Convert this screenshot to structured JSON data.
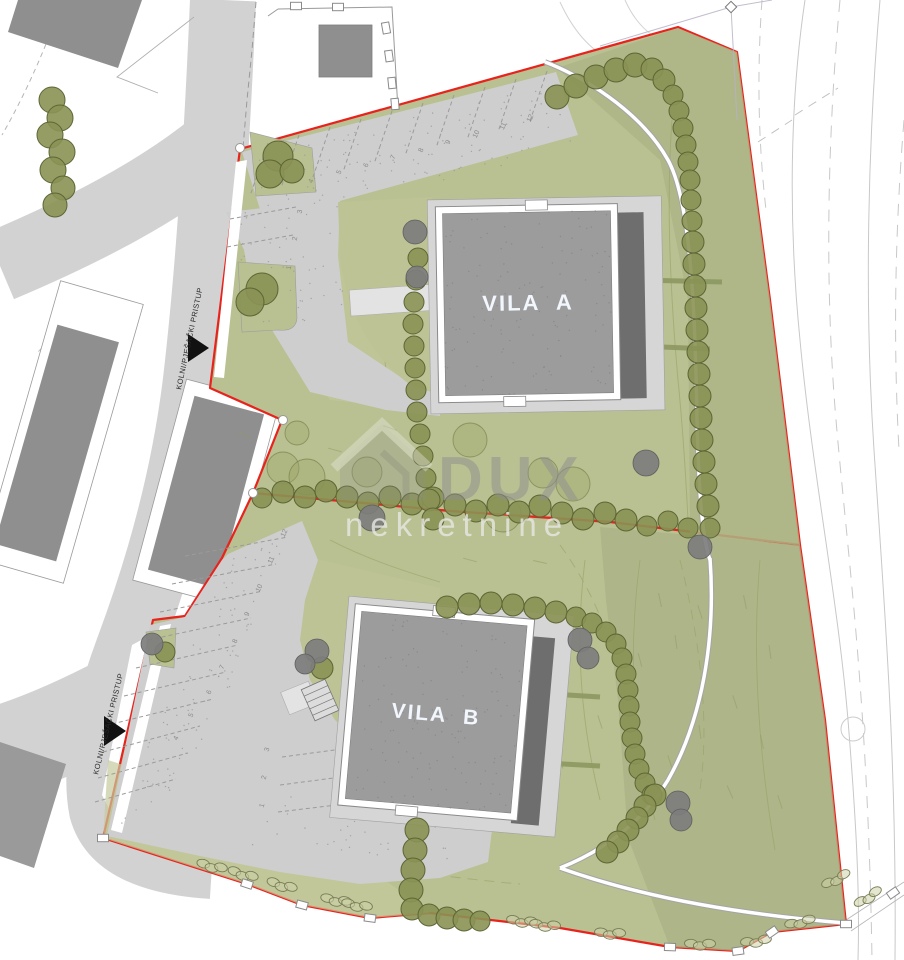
{
  "plan": {
    "type": "site-plan",
    "villas": {
      "a": {
        "label": "VILA A"
      },
      "b": {
        "label": "VILA B"
      }
    },
    "access": {
      "upper": "KOLNI/PJEŠAČKI PRISTUP",
      "lower": "KOLNI/PJEŠAČKI PRISTUP"
    },
    "parking": {
      "vila_a": {
        "spaces": [
          "1",
          "2",
          "3",
          "4",
          "5",
          "6",
          "7",
          "8",
          "9",
          "10",
          "11",
          "12"
        ]
      },
      "vila_b": {
        "spaces": [
          "1",
          "2",
          "3",
          "4",
          "5",
          "6",
          "7",
          "8",
          "9",
          "10",
          "11",
          "12"
        ]
      }
    },
    "watermark": {
      "brand": "DUX",
      "subtitle": "nekretnine"
    },
    "colors": {
      "boundary_red": "#e8231d",
      "parcel_green": "#b9c091",
      "parcel_green_dark": "#abb286",
      "parcel_green_light": "#c6ca9d",
      "road_grey": "#d2d2d2",
      "parking_grey": "#cecece",
      "building_grey": "#8f8f8f",
      "roof_grey": "#9c9c9c",
      "terrace_dark": "#6e6e6e",
      "tree_olive": "#8a9254",
      "tree_grey": "#7d7d7d",
      "contour_grey": "#c8c8c8"
    }
  }
}
